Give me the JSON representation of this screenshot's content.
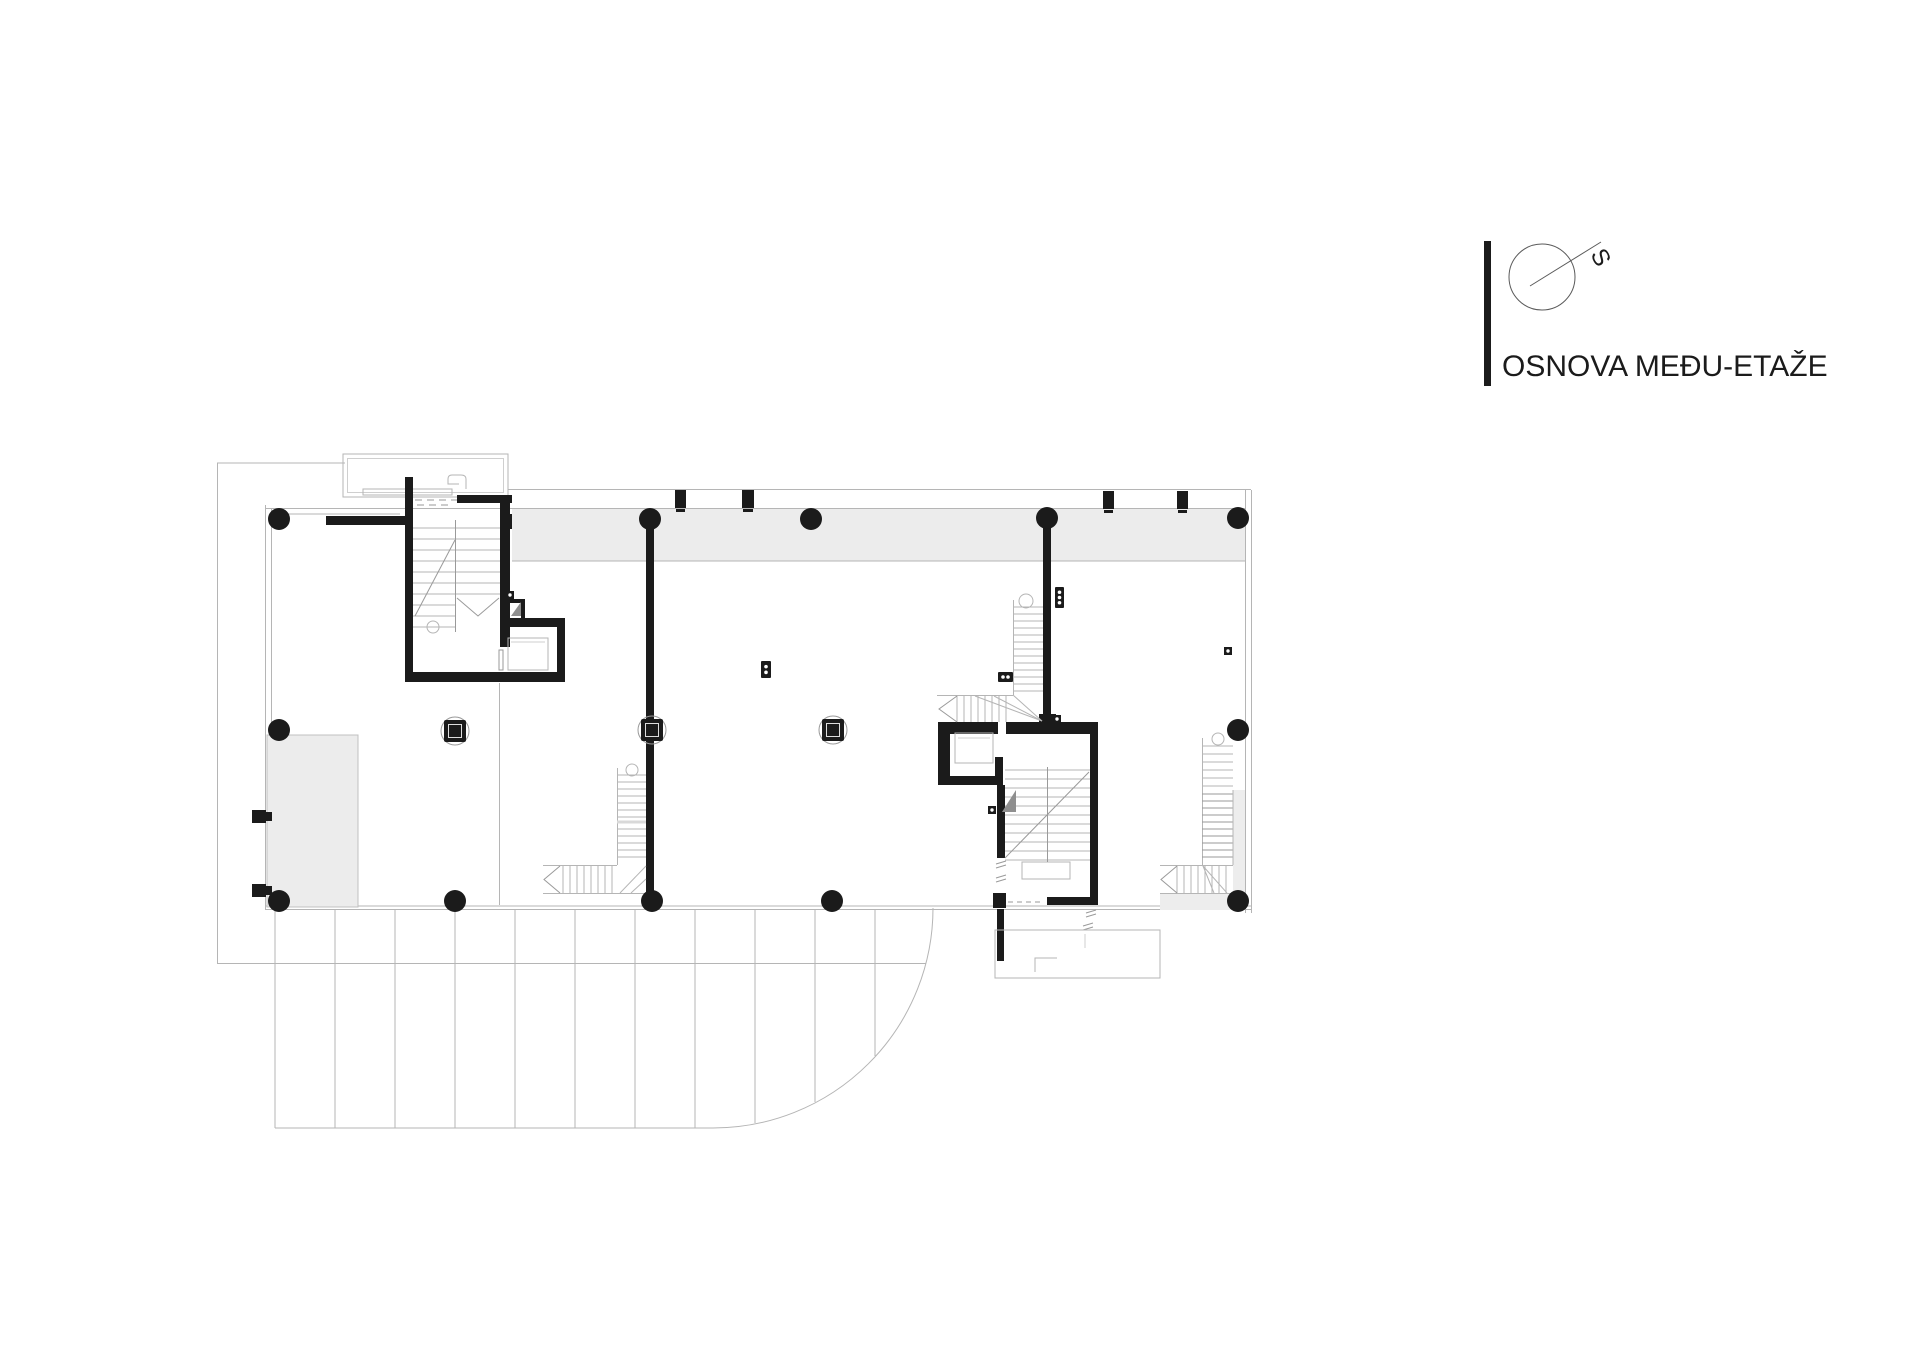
{
  "title_block": {
    "drawing_title": "OSNOVA MEĐU-ETAŽE",
    "north_label": "S"
  },
  "colors": {
    "ink": "#1b1b1b",
    "line_light": "#b5b5b5",
    "line_mid": "#9a9a9a",
    "band_fill": "#ececec",
    "zone_fill": "#ededed",
    "triangle_fill": "#8f8f8f",
    "background": "#ffffff"
  },
  "plan": {
    "columns_round": [
      [
        279,
        519
      ],
      [
        650,
        519
      ],
      [
        811,
        519
      ],
      [
        1047,
        518
      ],
      [
        1238,
        518
      ],
      [
        279,
        730
      ],
      [
        1238,
        730
      ],
      [
        279,
        901
      ],
      [
        455,
        901
      ],
      [
        652,
        901
      ],
      [
        832,
        901
      ],
      [
        1238,
        901
      ]
    ],
    "columns_square": [
      [
        455,
        731
      ],
      [
        652,
        730
      ],
      [
        833,
        730
      ]
    ],
    "terrace_lines": [
      [
        275,
        1128
      ],
      [
        335,
        1128
      ],
      [
        395,
        1128
      ],
      [
        455,
        1128
      ],
      [
        515,
        1128
      ],
      [
        575,
        1128
      ],
      [
        635,
        1128
      ],
      [
        695,
        1128
      ],
      [
        755,
        1123
      ],
      [
        815,
        1102
      ],
      [
        875,
        1056
      ]
    ],
    "dot_squares": [
      [
        506,
        591
      ],
      [
        1053,
        715
      ],
      [
        988,
        806
      ],
      [
        1224,
        647
      ]
    ],
    "multi_dot_markers": [
      {
        "x": 1055,
        "y": 587,
        "w": 9,
        "h": 21,
        "dots": 3,
        "horizontal": false
      },
      {
        "x": 761,
        "y": 661,
        "w": 10,
        "h": 17,
        "dots": 2,
        "horizontal": false
      },
      {
        "x": 998,
        "y": 672,
        "w": 15,
        "h": 10,
        "dots": 2,
        "horizontal": true
      }
    ]
  }
}
